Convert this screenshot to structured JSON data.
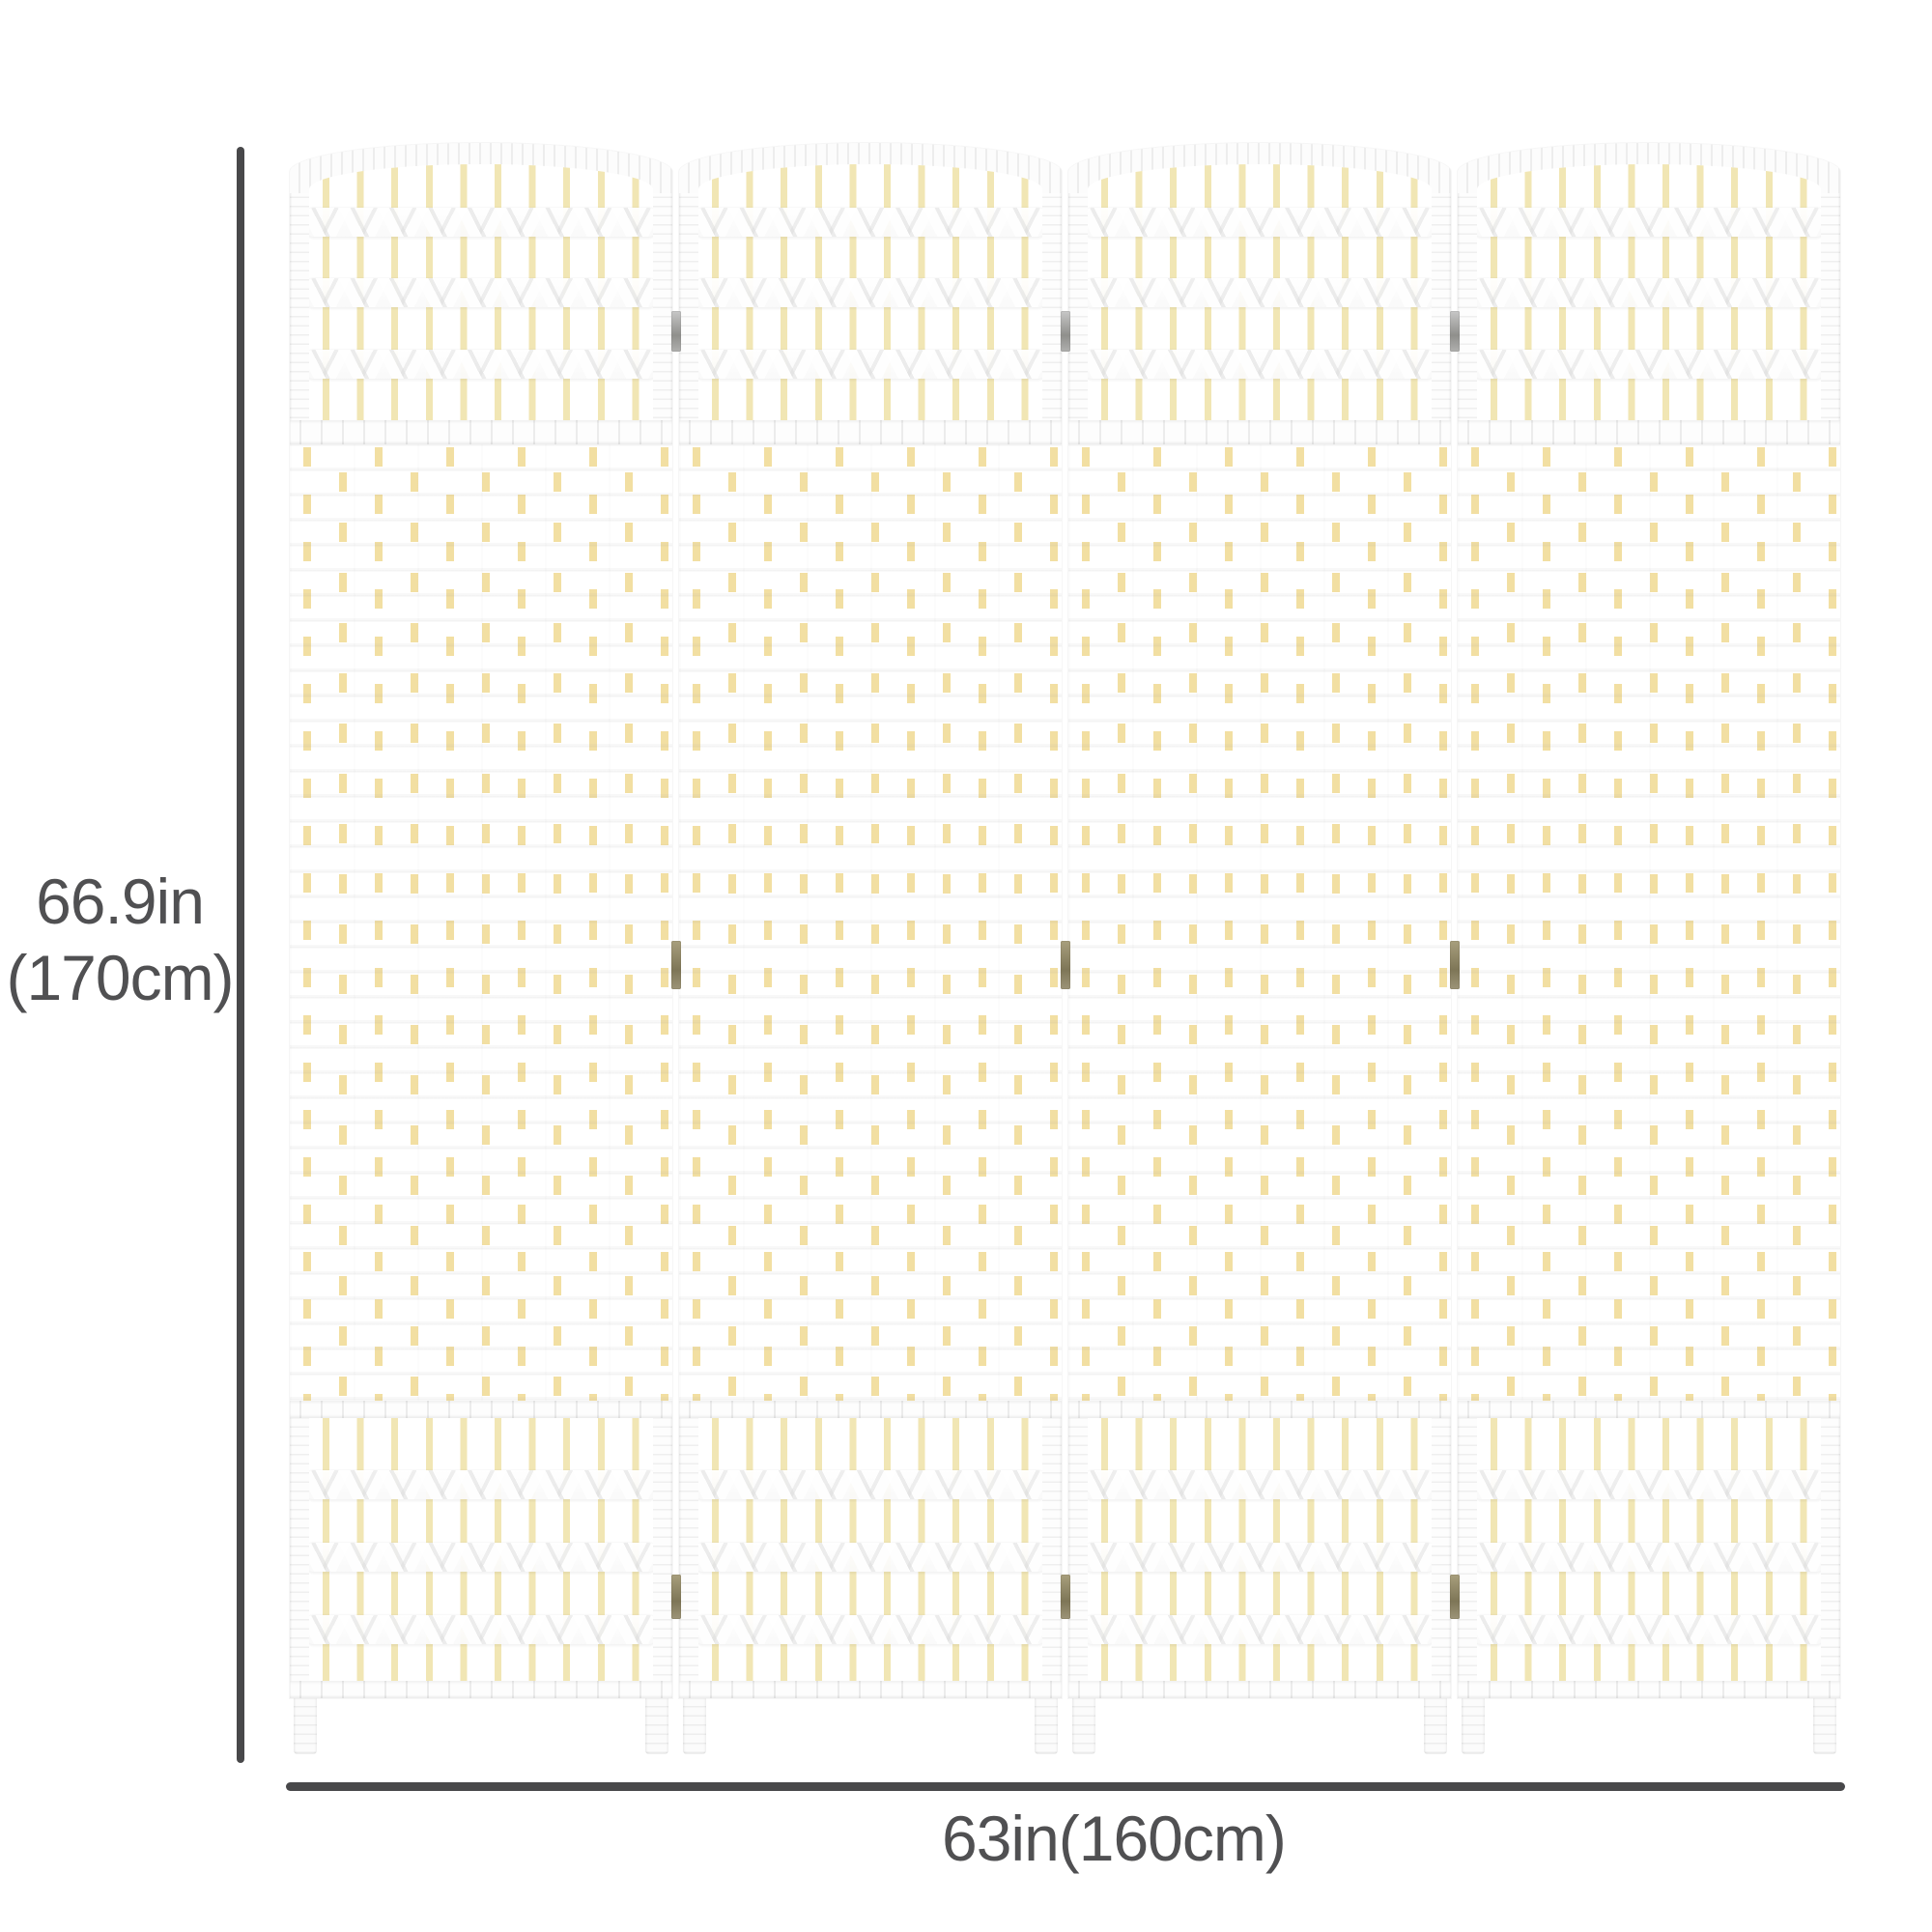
{
  "dimensions": {
    "height_in": "66.9in",
    "height_cm": "(170cm)",
    "width": "63in(160cm)"
  },
  "divider": {
    "panel_count": 4,
    "hinge_rows": 3,
    "lattice_band_rows": 3,
    "sticks_per_panel": 10
  },
  "colors": {
    "dimension_line": "#48484a",
    "label_text": "#505052",
    "frame_white": "#fdfdfd",
    "lattice_stick_cream": "#f1e6b4",
    "weave_stick_cream": "#f2dfa2",
    "hinge_bronze": "#8a8263",
    "hinge_silver": "#a8a8a6",
    "background": "#ffffff"
  }
}
